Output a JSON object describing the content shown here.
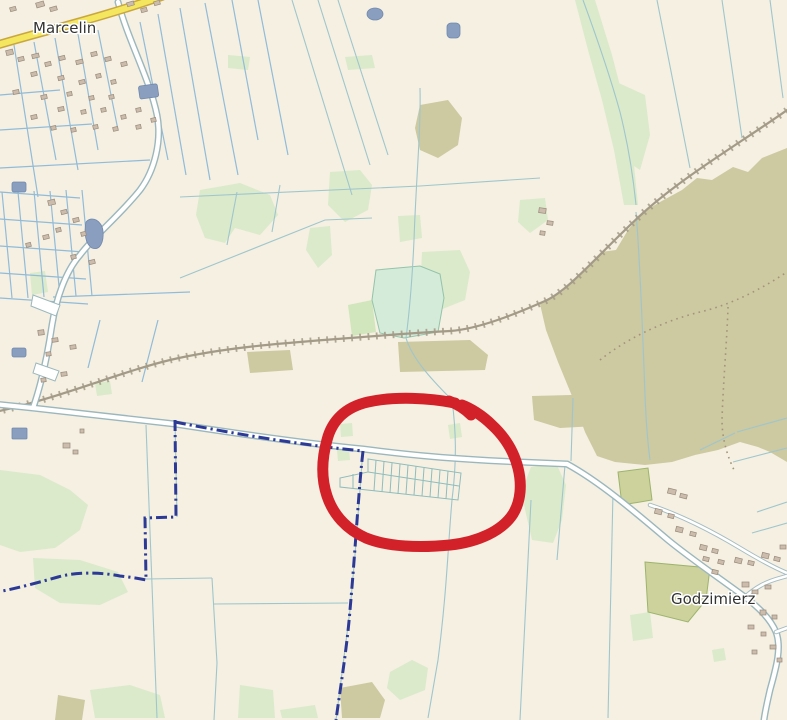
{
  "map": {
    "labels": {
      "marcelin": "Marcelin",
      "godzimierz": "Godzimierz"
    },
    "colors": {
      "land": "#f5f0e2",
      "annotation_red": "#d22129",
      "boundary_blue": "#2c3a96",
      "road_yellow": "#f4e65f",
      "scrub_khaki": "#cdc9a1",
      "green_area": "#dbeacb",
      "water": "#8a9fc0",
      "ditch_teal": "#9fc6cc",
      "railway_gray": "#a39a87",
      "label_text": "#333333"
    },
    "annotation": {
      "shape": "hand-drawn-ellipse",
      "stroke_width_px": 11
    }
  }
}
